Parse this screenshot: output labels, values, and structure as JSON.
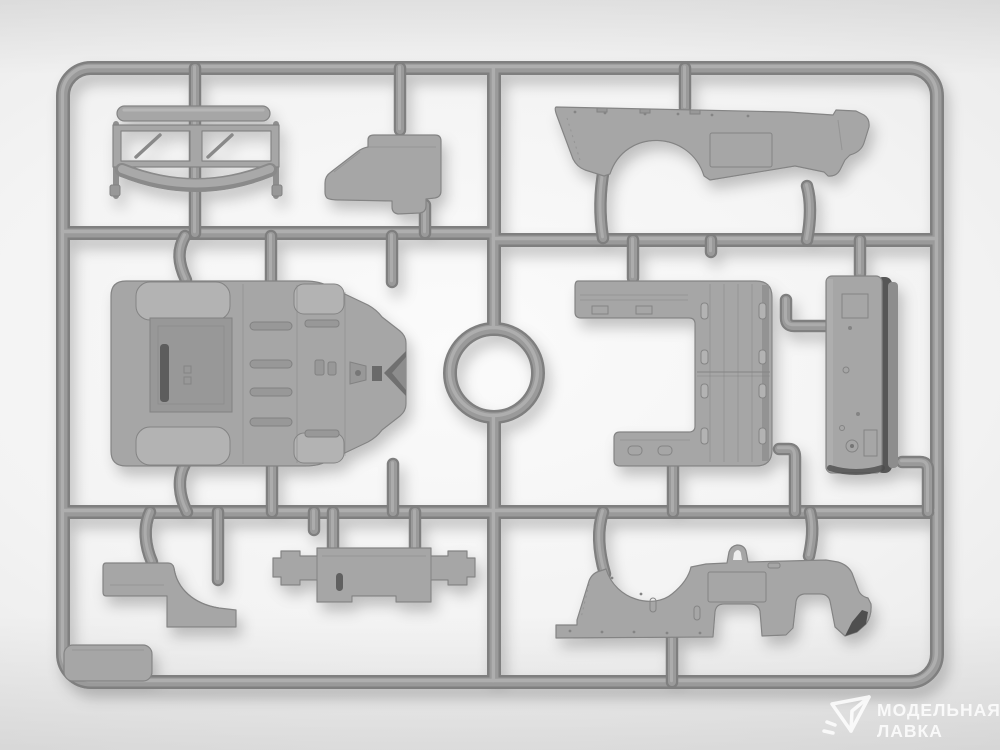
{
  "scene": {
    "type": "product-photo",
    "subject": "Gray plastic injection-molded model-kit sprue with stamped automotive body parts on a light studio background",
    "orientation": "landscape"
  },
  "watermark": {
    "icon": "paper-plane-icon",
    "line1": "МОДЕЛЬНАЯ",
    "line2": "ЛАВКА"
  },
  "colors": {
    "background_center": "#fbfbfb",
    "background_edge": "#dcdcdc",
    "runner": "#9a9a9a",
    "runner_shadow": "#7f7f7f",
    "runner_highlight": "#b2b2b2",
    "part": "#a6a6a6",
    "part_light": "#b3b3b3",
    "part_edge": "#848484",
    "dark_edge": "#4f4f4f",
    "watermark_text": "#ffffff"
  },
  "parts": [
    {
      "id": "windshield-frame",
      "description": "two-pane windshield frame with wipers, top bar and folded bow"
    },
    {
      "id": "seat-cowl-section",
      "description": "stepped seat / cowl section"
    },
    {
      "id": "body-side-panel-upper",
      "description": "long body side panel with wheel-arch cutout and scribed door"
    },
    {
      "id": "body-tub",
      "description": "body tub floor pan with wheel housings, ribbed floor and pedals"
    },
    {
      "id": "runner-ring",
      "description": "circular runner ring"
    },
    {
      "id": "engine-cover",
      "description": "C-shaped planked engine cover panel"
    },
    {
      "id": "front-panel",
      "description": "tall narrow panel with dark folded edge"
    },
    {
      "id": "corner-floor-panel",
      "description": "small rounded floor panel in frame corner"
    },
    {
      "id": "fender-step",
      "description": "stepped part with concave fender curve"
    },
    {
      "id": "bulkhead-panel",
      "description": "winged bulkhead / firewall panel with slot"
    },
    {
      "id": "body-side-panel-lower",
      "description": "long body side panel with arch, grab handle and sill cutouts"
    }
  ]
}
